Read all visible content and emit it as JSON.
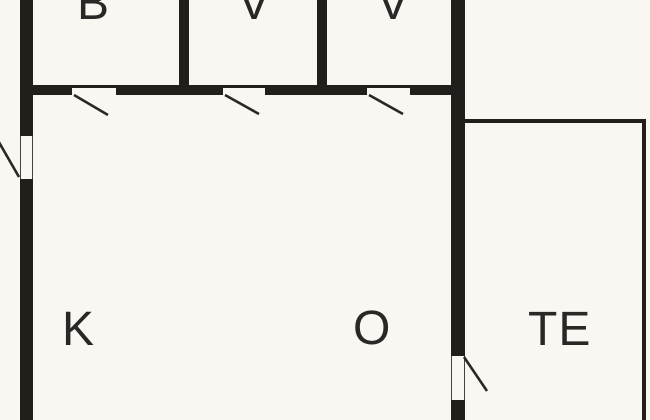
{
  "diagram": {
    "type": "floor-plan",
    "rooms": [
      {
        "id": "b",
        "label": "B"
      },
      {
        "id": "v1",
        "label": "V"
      },
      {
        "id": "v2",
        "label": "V"
      },
      {
        "id": "k",
        "label": "K"
      },
      {
        "id": "o",
        "label": "O"
      },
      {
        "id": "te",
        "label": "TE"
      }
    ],
    "door_count": 5
  },
  "colors": {
    "background": "#f8f7f2",
    "wall": "#211e1c",
    "label_text": "#2a2826",
    "door_line": "#2a2724"
  }
}
